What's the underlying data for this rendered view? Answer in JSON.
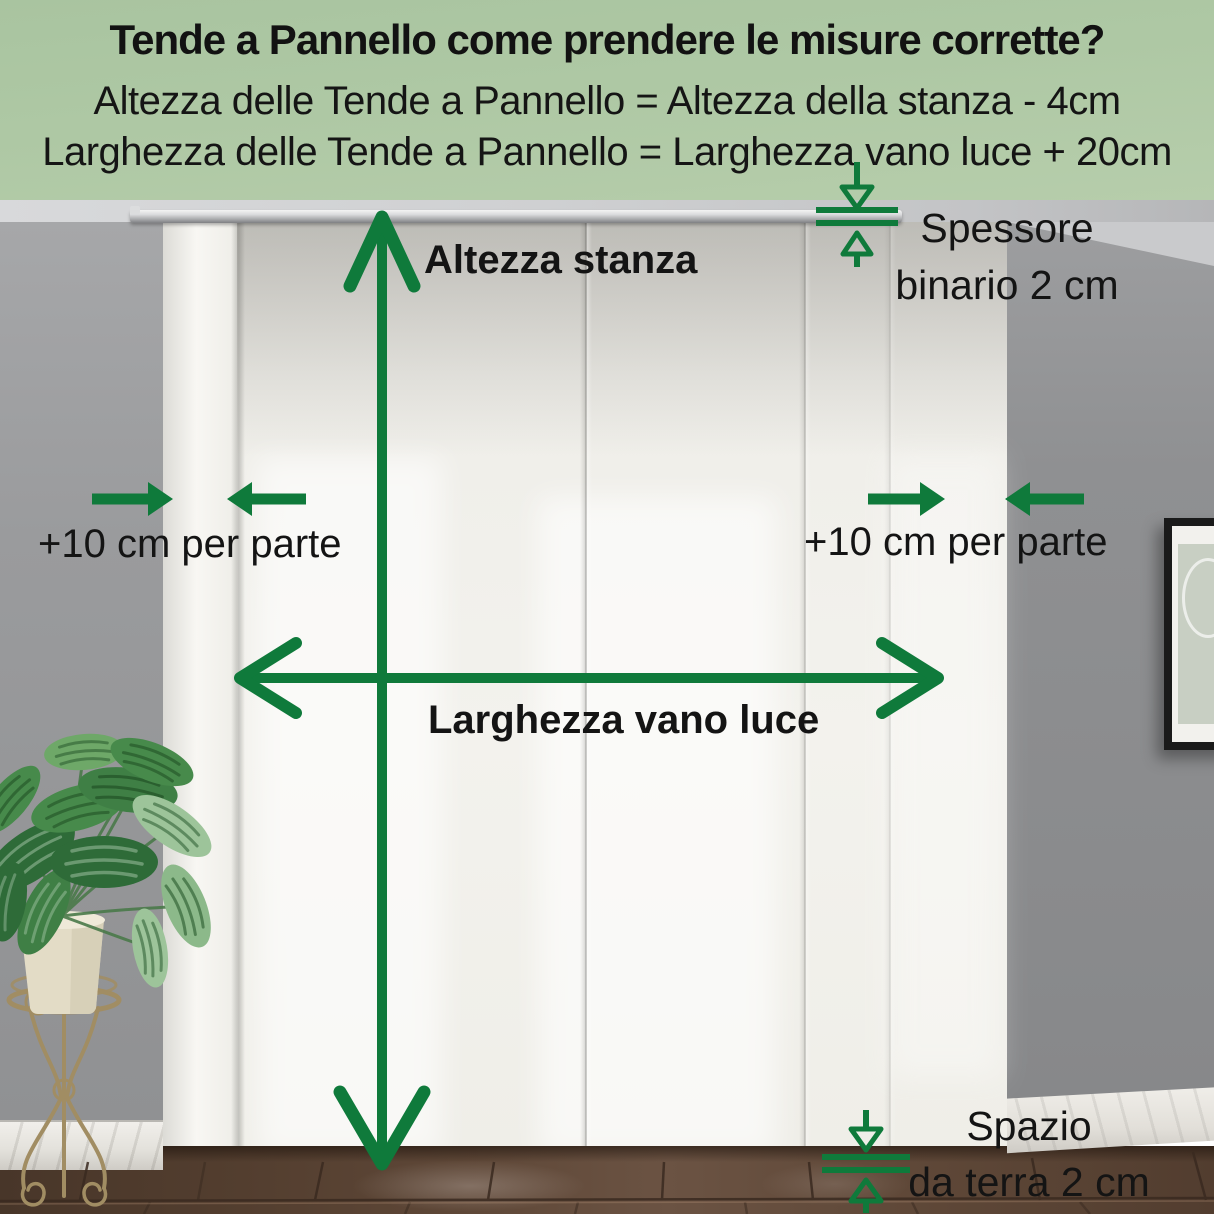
{
  "header": {
    "title": "Tende a Pannello come prendere le misure corrette?",
    "formula_height": "Altezza delle Tende a Pannello = Altezza della stanza - 4cm",
    "formula_width": "Larghezza delle Tende a Pannello = Larghezza vano luce + 20cm"
  },
  "annotations": {
    "room_height_label": "Altezza stanza",
    "opening_width_label": "Larghezza vano luce",
    "left_add_label": "+10 cm per parte",
    "right_add_label": "+10 cm per parte",
    "track_thickness": {
      "line1": "Spessore",
      "line2": "binario 2 cm"
    },
    "floor_gap": {
      "line1": "Spazio",
      "line2": "da terra 2 cm"
    }
  },
  "colors": {
    "arrow_green": "#0f7a3b",
    "header_background": "#aec8a4",
    "label_text": "#141414"
  }
}
